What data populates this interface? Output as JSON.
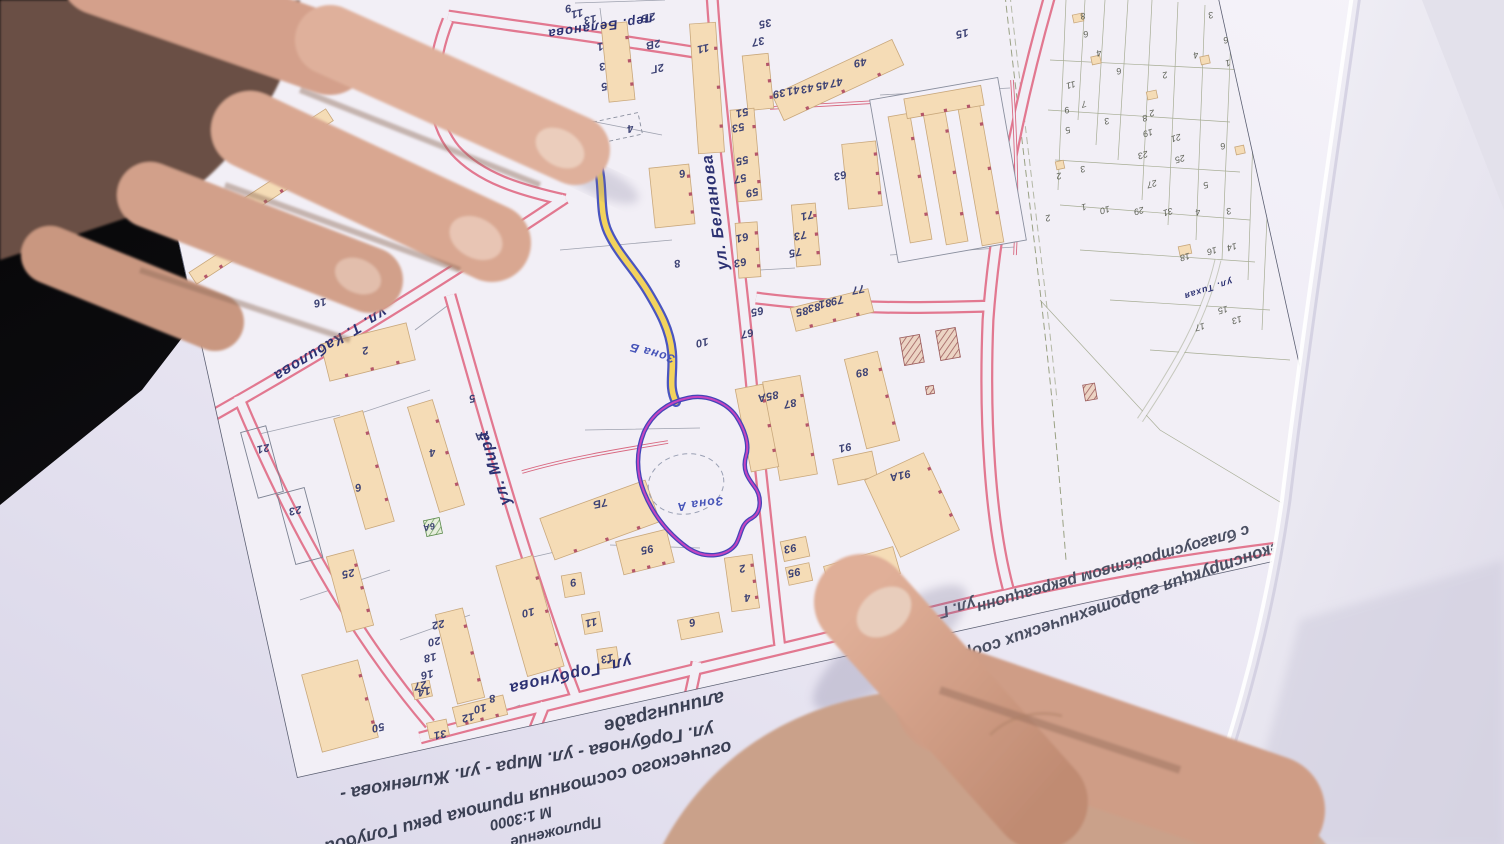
{
  "photo": {
    "scene": "hands holding a printed town-plan map, map rotated upside down"
  },
  "map": {
    "scale_note": "М 1:3000",
    "street_labels": [
      {
        "t": "пер. Беланова",
        "x": 600,
        "y": 27,
        "rot": 172,
        "fs": 13,
        "name": "street-label-per-belanova"
      },
      {
        "t": "ул. Беланова",
        "x": 716,
        "y": 212,
        "rot": 262,
        "fs": 16,
        "name": "street-label-belanova"
      },
      {
        "t": "ул. Т. Кабилова",
        "x": 330,
        "y": 344,
        "rot": 149,
        "fs": 15,
        "name": "street-label-kabilova"
      },
      {
        "t": "ул. Мира",
        "x": 495,
        "y": 468,
        "rot": 252,
        "fs": 16,
        "name": "street-label-mira"
      },
      {
        "t": "ул. Горбунова",
        "x": 570,
        "y": 674,
        "rot": 167,
        "fs": 16,
        "name": "street-label-gorbunova"
      },
      {
        "t": "ул. Тихая",
        "x": 1208,
        "y": 289,
        "rot": 162,
        "fs": 9,
        "name": "street-label-tikhaya"
      }
    ],
    "zone_labels": [
      {
        "t": "Зона А",
        "x": 700,
        "y": 504,
        "rot": 172,
        "fs": 12,
        "name": "zone-a-label"
      },
      {
        "t": "Зона Б",
        "x": 652,
        "y": 353,
        "rot": 196,
        "fs": 12,
        "name": "zone-b-label"
      }
    ],
    "house_numbers": [
      {
        "t": "9",
        "x": 568,
        "y": 8
      },
      {
        "t": "11",
        "x": 577,
        "y": 13
      },
      {
        "t": "13",
        "x": 590,
        "y": 19
      },
      {
        "t": "1",
        "x": 600,
        "y": 46
      },
      {
        "t": "3",
        "x": 602,
        "y": 66
      },
      {
        "t": "5",
        "x": 604,
        "y": 86
      },
      {
        "t": "4",
        "x": 630,
        "y": 128
      },
      {
        "t": "2Б",
        "x": 648,
        "y": 17
      },
      {
        "t": "2В",
        "x": 653,
        "y": 44
      },
      {
        "t": "2Г",
        "x": 657,
        "y": 68
      },
      {
        "t": "11",
        "x": 703,
        "y": 48
      },
      {
        "t": "35",
        "x": 765,
        "y": 23
      },
      {
        "t": "37",
        "x": 758,
        "y": 41
      },
      {
        "t": "39",
        "x": 779,
        "y": 93
      },
      {
        "t": "41",
        "x": 793,
        "y": 90
      },
      {
        "t": "43",
        "x": 807,
        "y": 88
      },
      {
        "t": "45",
        "x": 822,
        "y": 85
      },
      {
        "t": "47",
        "x": 836,
        "y": 82
      },
      {
        "t": "49",
        "x": 860,
        "y": 62
      },
      {
        "t": "51",
        "x": 742,
        "y": 112
      },
      {
        "t": "53",
        "x": 738,
        "y": 127
      },
      {
        "t": "55",
        "x": 742,
        "y": 160
      },
      {
        "t": "57",
        "x": 740,
        "y": 178
      },
      {
        "t": "59",
        "x": 752,
        "y": 192
      },
      {
        "t": "61",
        "x": 742,
        "y": 237
      },
      {
        "t": "63",
        "x": 740,
        "y": 262
      },
      {
        "t": "71",
        "x": 807,
        "y": 215
      },
      {
        "t": "73",
        "x": 800,
        "y": 235
      },
      {
        "t": "75",
        "x": 795,
        "y": 252
      },
      {
        "t": "63",
        "x": 840,
        "y": 175
      },
      {
        "t": "15",
        "x": 962,
        "y": 33
      },
      {
        "t": "6",
        "x": 682,
        "y": 173
      },
      {
        "t": "8",
        "x": 677,
        "y": 263
      },
      {
        "t": "10",
        "x": 702,
        "y": 342
      },
      {
        "t": "16",
        "x": 320,
        "y": 302
      },
      {
        "t": "2",
        "x": 365,
        "y": 350
      },
      {
        "t": "65",
        "x": 757,
        "y": 311
      },
      {
        "t": "67",
        "x": 747,
        "y": 333
      },
      {
        "t": "85",
        "x": 802,
        "y": 311
      },
      {
        "t": "83",
        "x": 814,
        "y": 307
      },
      {
        "t": "81",
        "x": 825,
        "y": 303
      },
      {
        "t": "79",
        "x": 837,
        "y": 300
      },
      {
        "t": "77",
        "x": 858,
        "y": 289
      },
      {
        "t": "85А",
        "x": 768,
        "y": 396
      },
      {
        "t": "87",
        "x": 790,
        "y": 403
      },
      {
        "t": "89",
        "x": 862,
        "y": 372
      },
      {
        "t": "91",
        "x": 845,
        "y": 447
      },
      {
        "t": "91А",
        "x": 900,
        "y": 475
      },
      {
        "t": "7Б",
        "x": 600,
        "y": 503
      },
      {
        "t": "7А",
        "x": 482,
        "y": 435
      },
      {
        "t": "5",
        "x": 472,
        "y": 398
      },
      {
        "t": "95",
        "x": 647,
        "y": 549
      },
      {
        "t": "93",
        "x": 790,
        "y": 548
      },
      {
        "t": "95",
        "x": 794,
        "y": 572
      },
      {
        "t": "97",
        "x": 856,
        "y": 562
      },
      {
        "t": "2",
        "x": 742,
        "y": 568
      },
      {
        "t": "4",
        "x": 747,
        "y": 597
      },
      {
        "t": "6",
        "x": 692,
        "y": 622
      },
      {
        "t": "13",
        "x": 607,
        "y": 658
      },
      {
        "t": "9",
        "x": 573,
        "y": 582
      },
      {
        "t": "11",
        "x": 591,
        "y": 622
      },
      {
        "t": "10",
        "x": 528,
        "y": 612
      },
      {
        "t": "4",
        "x": 432,
        "y": 452
      },
      {
        "t": "6",
        "x": 358,
        "y": 487
      },
      {
        "t": "6А",
        "x": 429,
        "y": 527,
        "fs": 9
      },
      {
        "t": "25",
        "x": 348,
        "y": 573
      },
      {
        "t": "23",
        "x": 295,
        "y": 510
      },
      {
        "t": "21",
        "x": 263,
        "y": 448
      },
      {
        "t": "50",
        "x": 378,
        "y": 727
      },
      {
        "t": "31",
        "x": 440,
        "y": 734
      },
      {
        "t": "27",
        "x": 420,
        "y": 685
      },
      {
        "t": "22",
        "x": 438,
        "y": 624
      },
      {
        "t": "20",
        "x": 434,
        "y": 641
      },
      {
        "t": "18",
        "x": 430,
        "y": 657
      },
      {
        "t": "16",
        "x": 427,
        "y": 674
      },
      {
        "t": "14",
        "x": 424,
        "y": 691
      },
      {
        "t": "12",
        "x": 468,
        "y": 717
      },
      {
        "t": "10",
        "x": 480,
        "y": 708
      },
      {
        "t": "8",
        "x": 492,
        "y": 698
      }
    ],
    "parcel_numbers": [
      {
        "t": "8",
        "x": 1083,
        "y": 16
      },
      {
        "t": "6",
        "x": 1086,
        "y": 34
      },
      {
        "t": "4",
        "x": 1099,
        "y": 53
      },
      {
        "t": "6",
        "x": 1119,
        "y": 71
      },
      {
        "t": "2",
        "x": 1165,
        "y": 75
      },
      {
        "t": "3",
        "x": 1211,
        "y": 15
      },
      {
        "t": "4",
        "x": 1196,
        "y": 55
      },
      {
        "t": "6",
        "x": 1226,
        "y": 40
      },
      {
        "t": "1",
        "x": 1228,
        "y": 63
      },
      {
        "t": "11",
        "x": 1071,
        "y": 85
      },
      {
        "t": "9",
        "x": 1067,
        "y": 110
      },
      {
        "t": "7",
        "x": 1084,
        "y": 104
      },
      {
        "t": "5",
        "x": 1068,
        "y": 130
      },
      {
        "t": "3",
        "x": 1107,
        "y": 121
      },
      {
        "t": "2",
        "x": 1059,
        "y": 176
      },
      {
        "t": "3",
        "x": 1083,
        "y": 169
      },
      {
        "t": "8",
        "x": 1145,
        "y": 118
      },
      {
        "t": "2",
        "x": 1152,
        "y": 113
      },
      {
        "t": "19",
        "x": 1148,
        "y": 133
      },
      {
        "t": "21",
        "x": 1176,
        "y": 138
      },
      {
        "t": "23",
        "x": 1143,
        "y": 155
      },
      {
        "t": "25",
        "x": 1180,
        "y": 159
      },
      {
        "t": "27",
        "x": 1152,
        "y": 184
      },
      {
        "t": "29",
        "x": 1139,
        "y": 211
      },
      {
        "t": "31",
        "x": 1168,
        "y": 212
      },
      {
        "t": "10",
        "x": 1105,
        "y": 210
      },
      {
        "t": "1",
        "x": 1084,
        "y": 207
      },
      {
        "t": "6",
        "x": 1223,
        "y": 146
      },
      {
        "t": "5",
        "x": 1206,
        "y": 185
      },
      {
        "t": "3",
        "x": 1229,
        "y": 211
      },
      {
        "t": "4",
        "x": 1198,
        "y": 212
      },
      {
        "t": "14",
        "x": 1232,
        "y": 247
      },
      {
        "t": "16",
        "x": 1212,
        "y": 251
      },
      {
        "t": "18",
        "x": 1185,
        "y": 257
      },
      {
        "t": "15",
        "x": 1223,
        "y": 310
      },
      {
        "t": "13",
        "x": 1237,
        "y": 320
      },
      {
        "t": "17",
        "x": 1200,
        "y": 327
      },
      {
        "t": "2",
        "x": 1048,
        "y": 218
      }
    ],
    "buildings": [
      [
        707,
        88,
        26,
        130,
        -4
      ],
      [
        604,
        131,
        74,
        22,
        -12,
        "dash"
      ],
      [
        672,
        196,
        40,
        60,
        -6
      ],
      [
        838,
        80,
        132,
        28,
        -25
      ],
      [
        758,
        82,
        26,
        55,
        -6
      ],
      [
        746,
        155,
        24,
        92,
        -5
      ],
      [
        748,
        250,
        22,
        55,
        -4
      ],
      [
        806,
        235,
        24,
        62,
        -5
      ],
      [
        862,
        175,
        34,
        65,
        -6
      ],
      [
        948,
        170,
        130,
        165,
        -10,
        "outline"
      ],
      [
        910,
        178,
        22,
        128,
        -10
      ],
      [
        945,
        174,
        22,
        140,
        -10
      ],
      [
        980,
        170,
        22,
        150,
        -10
      ],
      [
        944,
        102,
        78,
        20,
        -10
      ],
      [
        832,
        310,
        80,
        24,
        -14
      ],
      [
        790,
        428,
        38,
        100,
        -10
      ],
      [
        757,
        428,
        28,
        84,
        -11
      ],
      [
        872,
        400,
        34,
        92,
        -14
      ],
      [
        855,
        468,
        40,
        26,
        -12
      ],
      [
        912,
        505,
        65,
        85,
        -25
      ],
      [
        600,
        520,
        112,
        44,
        -20
      ],
      [
        645,
        552,
        52,
        34,
        -14
      ],
      [
        795,
        549,
        26,
        20,
        -12
      ],
      [
        799,
        574,
        24,
        18,
        -12
      ],
      [
        862,
        570,
        72,
        28,
        -16
      ],
      [
        742,
        583,
        28,
        54,
        -8
      ],
      [
        700,
        626,
        42,
        20,
        -11
      ],
      [
        608,
        658,
        20,
        20,
        -8
      ],
      [
        530,
        616,
        38,
        115,
        -16
      ],
      [
        573,
        585,
        20,
        22,
        -10
      ],
      [
        592,
        623,
        18,
        20,
        -10
      ],
      [
        436,
        456,
        26,
        110,
        -17
      ],
      [
        364,
        470,
        30,
        115,
        -16
      ],
      [
        368,
        352,
        88,
        38,
        -14
      ],
      [
        262,
        462,
        26,
        68,
        -15,
        "outline2"
      ],
      [
        300,
        526,
        28,
        72,
        -15,
        "outline2"
      ],
      [
        350,
        591,
        28,
        78,
        -15
      ],
      [
        340,
        706,
        58,
        80,
        -15
      ],
      [
        438,
        729,
        20,
        16,
        -12
      ],
      [
        460,
        656,
        28,
        92,
        -14
      ],
      [
        480,
        711,
        52,
        20,
        -14
      ],
      [
        422,
        690,
        18,
        16,
        -12
      ],
      [
        618,
        62,
        26,
        78,
        -6
      ],
      [
        628,
        728,
        110,
        32,
        -14
      ],
      [
        433,
        527,
        16,
        16,
        -12,
        "green"
      ],
      [
        912,
        350,
        20,
        28,
        -10,
        "hatch"
      ],
      [
        948,
        344,
        20,
        30,
        -10,
        "hatch"
      ],
      [
        930,
        390,
        8,
        8,
        -10,
        "hatch"
      ],
      [
        1090,
        392,
        12,
        16,
        -10,
        "hatch"
      ],
      [
        1078,
        18,
        10,
        8,
        -12
      ],
      [
        1096,
        60,
        9,
        8,
        -12
      ],
      [
        1060,
        165,
        8,
        8,
        -12
      ],
      [
        1152,
        95,
        10,
        8,
        -12
      ],
      [
        1185,
        250,
        12,
        9,
        -12
      ],
      [
        1240,
        150,
        9,
        8,
        -12
      ],
      [
        1205,
        60,
        9,
        8,
        -12
      ],
      [
        262,
        196,
        64,
        16,
        -33
      ],
      [
        306,
        130,
        56,
        14,
        -33
      ],
      [
        218,
        262,
        60,
        14,
        -33
      ]
    ]
  },
  "titles": {
    "left_block": [
      {
        "t": "алининграде",
        "x": 664,
        "y": 711,
        "rot": 166,
        "fs": 19,
        "name": "title-city-line"
      },
      {
        "t": "ул. Горбунова - ул. Мира - ул. Жиленкова -",
        "x": 527,
        "y": 762,
        "rot": 170,
        "fs": 18,
        "name": "title-streets-line"
      },
      {
        "t": "огического состояния притока реки Голубой",
        "x": 528,
        "y": 797,
        "rot": 166,
        "fs": 18,
        "name": "title-river-line"
      },
      {
        "t": "М 1:3000",
        "x": 521,
        "y": 818,
        "rot": 167,
        "fs": 15,
        "name": "map-scale"
      },
      {
        "t": "Приложение",
        "x": 556,
        "y": 832,
        "rot": 167,
        "fs": 15,
        "name": "attachment-label"
      }
    ],
    "right_block": [
      {
        "t": "с благоустройством рекреационн",
        "x": 1113,
        "y": 568,
        "rot": 164,
        "fs": 16,
        "name": "project-line-2"
      },
      {
        "t": "Реконструкция гидротехнических соору",
        "x": 1122,
        "y": 601,
        "rot": 161,
        "fs": 17,
        "name": "project-line-1"
      },
      {
        "t": "ул. Г",
        "x": 957,
        "y": 607,
        "rot": 164,
        "fs": 16,
        "name": "project-line-3"
      }
    ]
  },
  "colors": {
    "road_edge": "#e27890",
    "building_fill": "#f5dcb6",
    "creek_fill": "#f2d35c",
    "creek_edge": "#4a55c0",
    "zone_a_outer": "#4444b8",
    "zone_a_inner": "#c445c0",
    "paper": "#efecf6",
    "background": "#0b0b0e",
    "street_text": "#2c3172"
  }
}
